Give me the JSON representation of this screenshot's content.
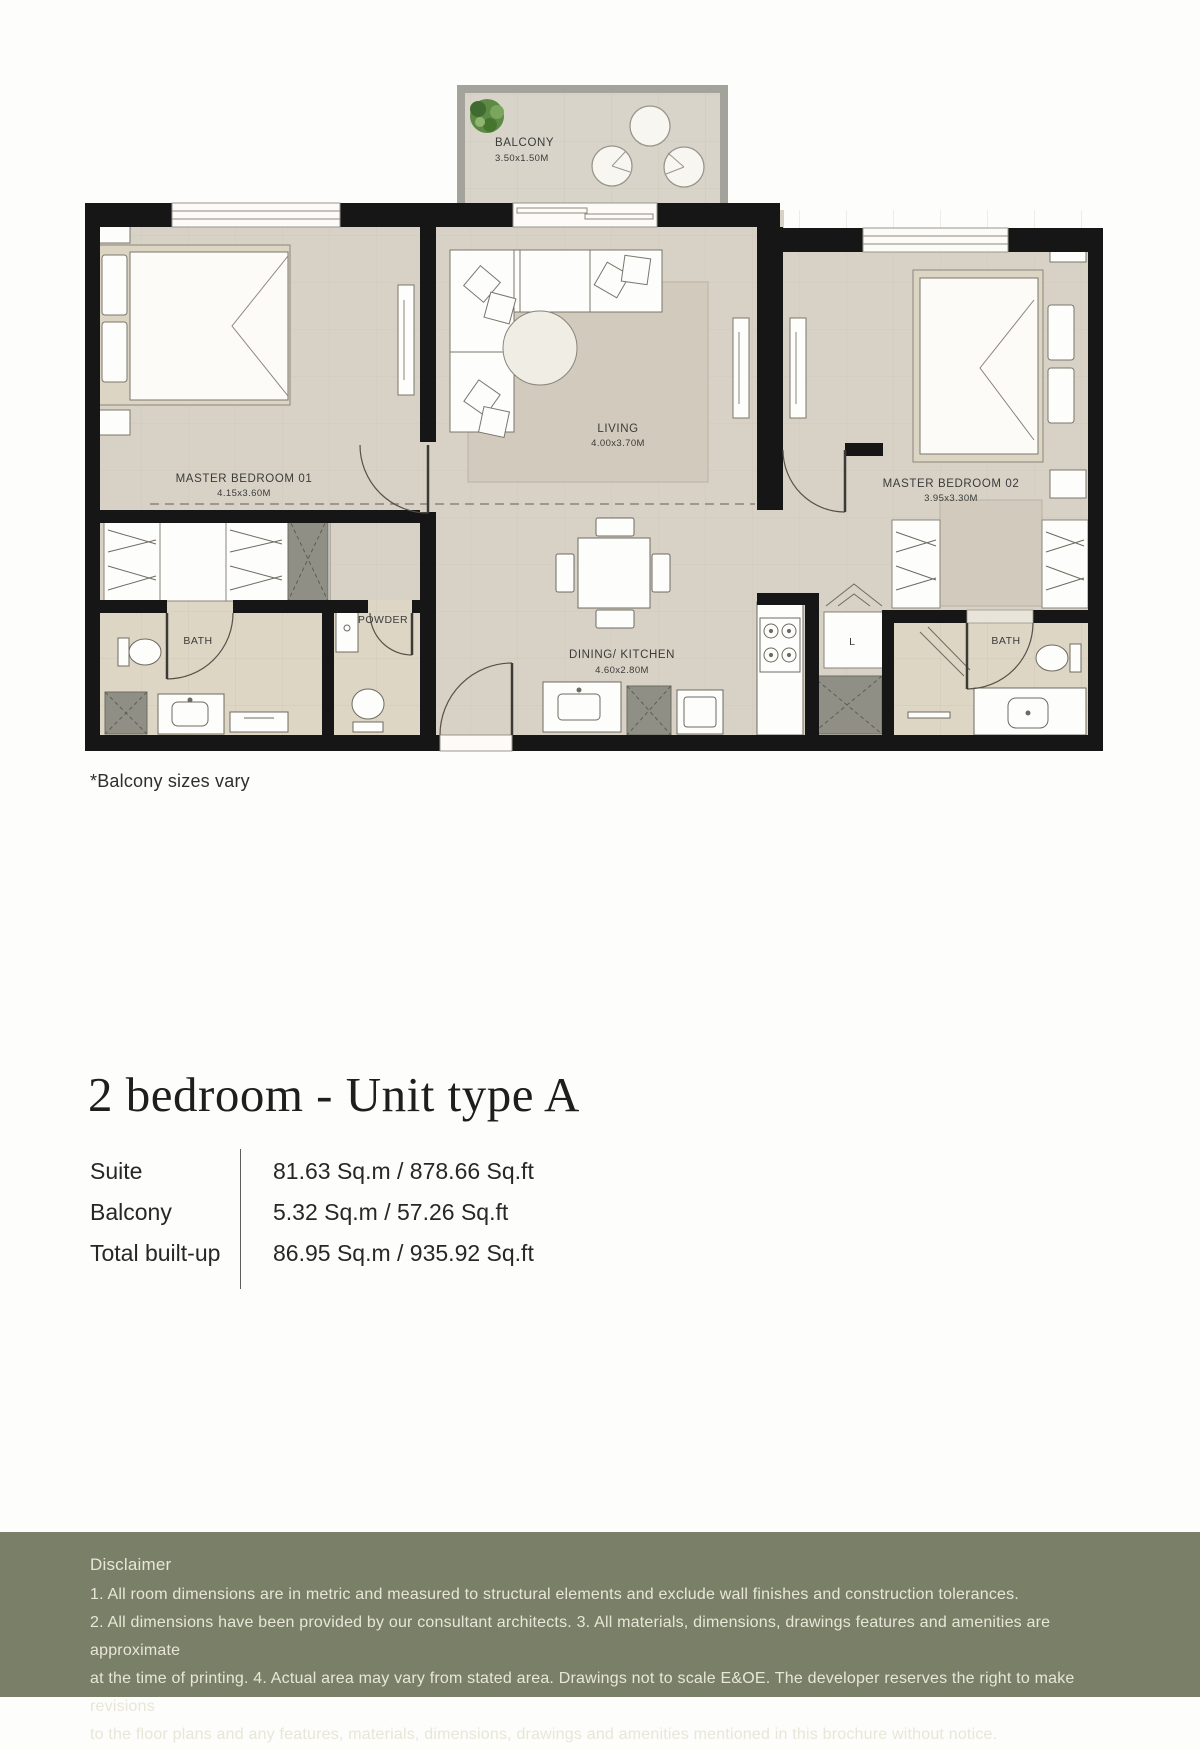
{
  "floor_plan": {
    "balcony": {
      "name": "BALCONY",
      "dims": "3.50x1.50M"
    },
    "rooms": {
      "master_bedroom_01": {
        "name": "MASTER BEDROOM 01",
        "dims": "4.15x3.60M"
      },
      "living": {
        "name": "LIVING",
        "dims": "4.00x3.70M"
      },
      "master_bedroom_02": {
        "name": "MASTER BEDROOM 02",
        "dims": "3.95x3.30M"
      },
      "dining_kitchen": {
        "name": "DINING/ KITCHEN",
        "dims": "4.60x2.80M"
      },
      "bath_1": {
        "name": "BATH"
      },
      "powder": {
        "name": "POWDER"
      },
      "bath_2": {
        "name": "BATH"
      },
      "laundry": {
        "name": "L"
      }
    }
  },
  "note": "*Balcony sizes vary",
  "unit": {
    "title": "2 bedroom - Unit type A",
    "areas": [
      {
        "label": "Suite",
        "value": "81.63 Sq.m / 878.66 Sq.ft"
      },
      {
        "label": "Balcony",
        "value": "5.32 Sq.m / 57.26 Sq.ft"
      },
      {
        "label": "Total built-up",
        "value": "86.95 Sq.m / 935.92 Sq.ft"
      }
    ]
  },
  "disclaimer": {
    "heading": "Disclaimer",
    "lines": [
      "1. All room dimensions are in metric and measured to structural elements and exclude wall finishes and construction tolerances.",
      "2. All dimensions have been provided by our consultant architects. 3. All materials, dimensions, drawings features and amenities are approximate",
      "at the time of printing. 4. Actual area may vary from stated area. Drawings not to scale E&OE. The developer reserves the right to make revisions",
      "to the floor plans and any features, materials, dimensions, drawings and amenities mentioned in this brochure without notice."
    ]
  },
  "colors": {
    "wall": "#161616",
    "floor": "#d8d2c6",
    "bath_floor": "#ddd6c4",
    "rug": "#d2cabc",
    "bed_frame": "#dcd5c4",
    "grey_fixture": "#8f8f85",
    "balcony_wall": "#a3a39b",
    "plant_green": "#5c8a44",
    "disclaimer_bg": "#798067",
    "disclaimer_text": "#e8e6d8"
  }
}
